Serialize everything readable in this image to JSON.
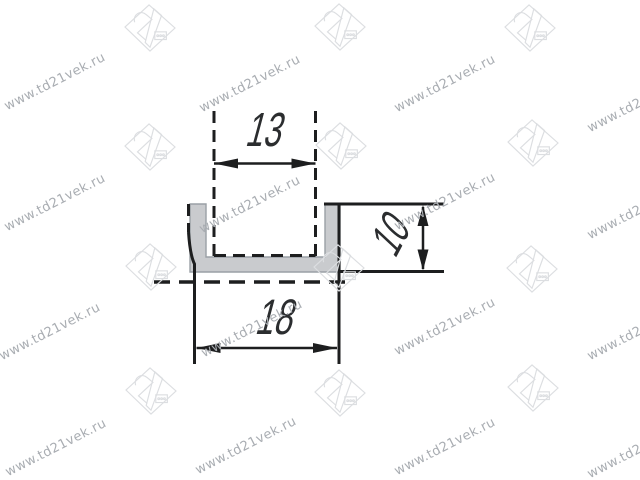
{
  "watermark": {
    "text": "www.td21vek.ru",
    "logo_label": "21",
    "text_color": "#a9adb2",
    "logo_color": "#dcdee1"
  },
  "drawing": {
    "subject": "u-channel-profile-cross-section",
    "profile_fill_color": "#c9cbce",
    "line_color": "#1d1e1f",
    "dimensions": {
      "inner_width": "13",
      "outer_width": "18",
      "height": "10"
    }
  }
}
